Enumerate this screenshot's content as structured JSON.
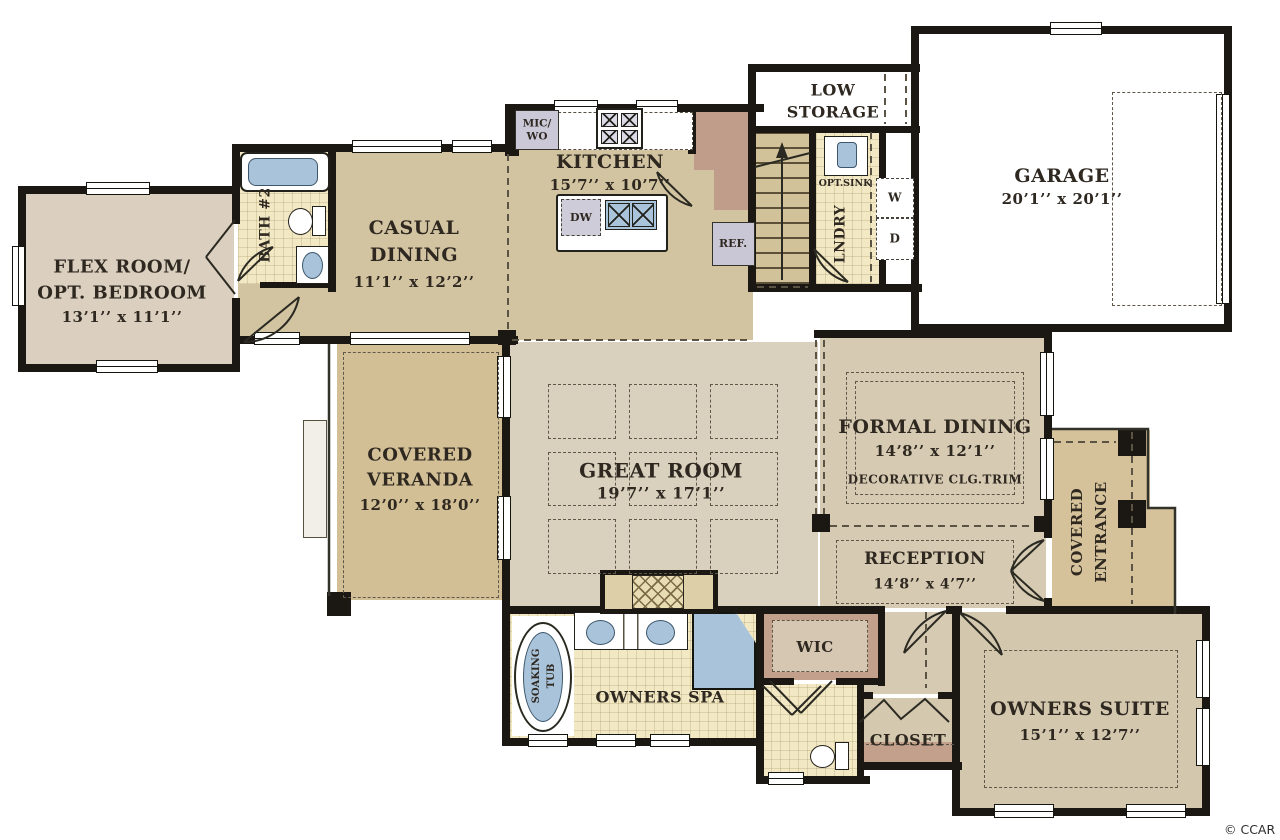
{
  "watermark": "© CCAR",
  "colors": {
    "wall": "#1b1813",
    "tan": "#d2c4a1",
    "beige": "#d9d0bd",
    "beige2": "#d6cab2",
    "beige3": "#d3c7ae",
    "pink": "#dbd0bf",
    "tile": "#f2e8c4",
    "veranda": "#d2bf96",
    "entrance": "#d5c29a",
    "brown": "#c2a08c",
    "mud": "#bf9d8a",
    "blue": "#a9c4da",
    "ref": "#c9c6d6",
    "stair": "#d2c29a"
  },
  "rooms": {
    "flex": {
      "line1": "FLEX ROOM/",
      "line2": "OPT. BEDROOM",
      "dims": "13’1’’ x 11’1’’"
    },
    "bath2": {
      "name": "BATH #2"
    },
    "casual_dining": {
      "line1": "CASUAL",
      "line2": "DINING",
      "dims": "11’1’’ x 12’2’’"
    },
    "kitchen": {
      "name": "KITCHEN",
      "dims": "15’7’’ x 10’7’’"
    },
    "low_storage": {
      "line1": "LOW",
      "line2": "STORAGE"
    },
    "laundry": {
      "name": "LNDRY",
      "opt_sink": "OPT.SINK",
      "washer": "W",
      "dryer": "D"
    },
    "garage": {
      "name": "GARAGE",
      "dims": "20’1’’ x 20’1’’"
    },
    "veranda": {
      "line1": "COVERED",
      "line2": "VERANDA",
      "dims": "12’0’’ x 18’0’’"
    },
    "great_room": {
      "name": "GREAT ROOM",
      "dims": "19’7’’ x 17’1’’"
    },
    "formal_dining": {
      "name": "FORMAL DINING",
      "dims": "14’8’’ x 12’1’’",
      "note": "DECORATIVE CLG.TRIM"
    },
    "reception": {
      "name": "RECEPTION",
      "dims": "14’8’’ x 4’7’’"
    },
    "covered_entrance": {
      "line1": "COVERED",
      "line2": "ENTRANCE"
    },
    "owners_spa": {
      "name": "OWNERS SPA",
      "tub_line1": "SOAKING",
      "tub_line2": "TUB"
    },
    "wic": {
      "name": "WIC"
    },
    "closet": {
      "name": "CLOSET"
    },
    "owners_suite": {
      "name": "OWNERS SUITE",
      "dims": "15’1’’ x 12’7’’"
    }
  },
  "kitchen_fixtures": {
    "mic_wo_line1": "MIC/",
    "mic_wo_line2": "WO",
    "dw": "DW",
    "ref": "REF."
  }
}
